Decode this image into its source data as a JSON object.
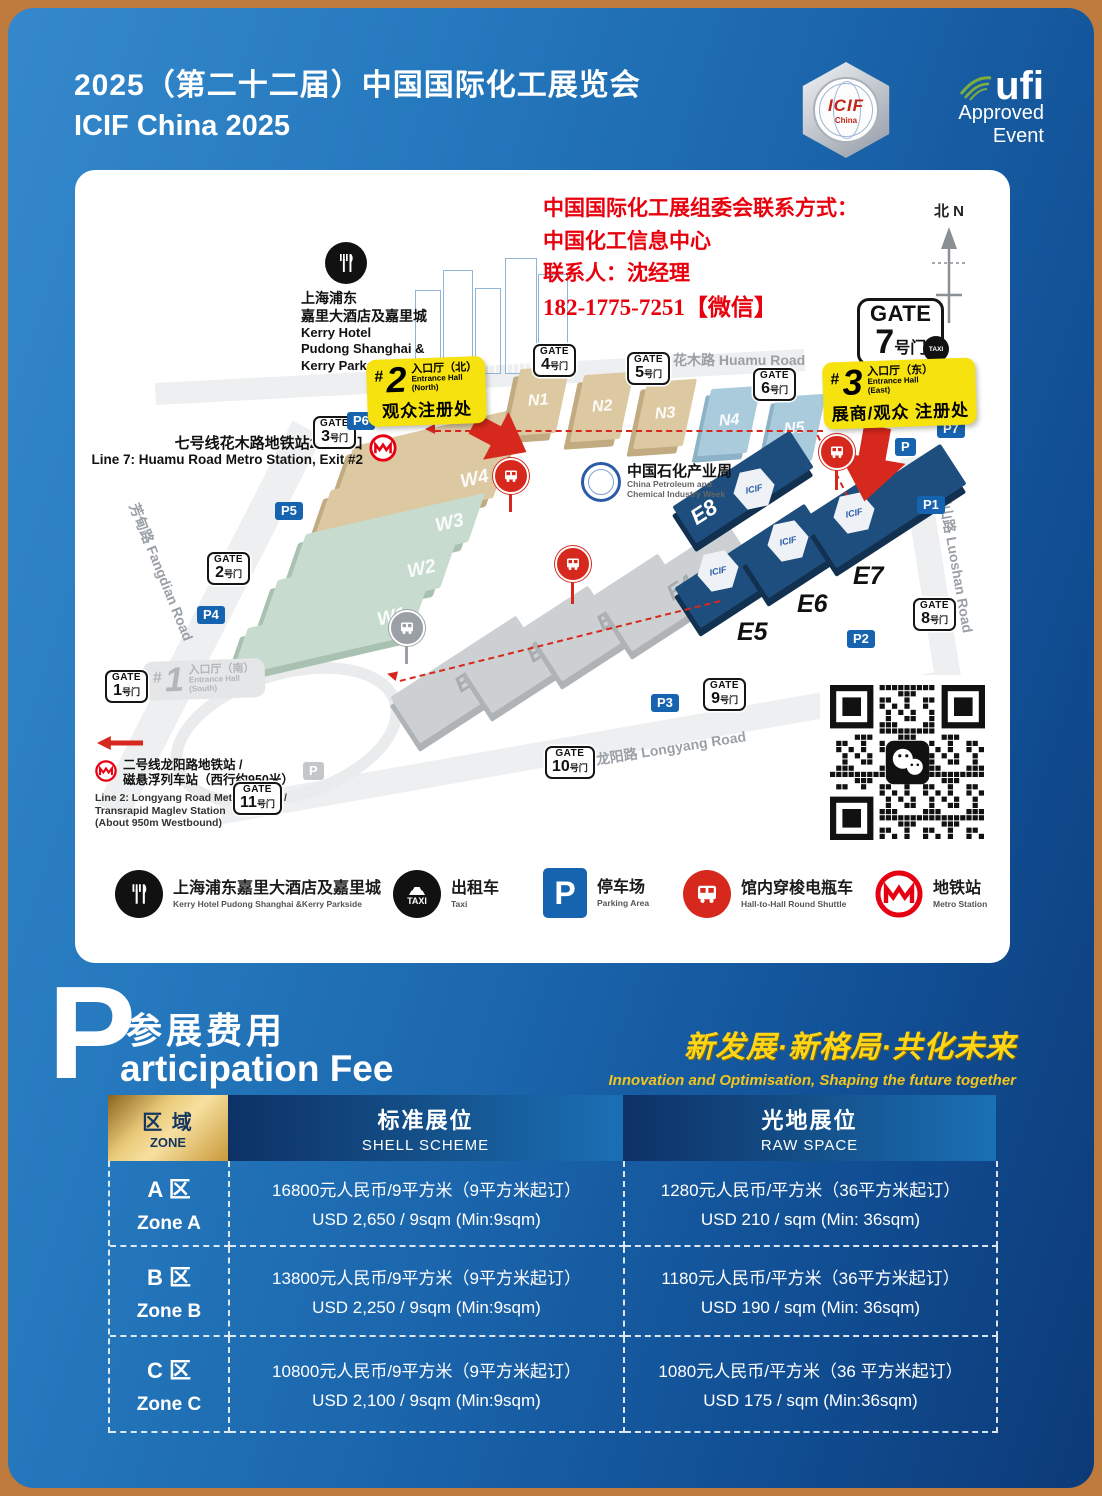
{
  "header": {
    "title_zh": "2025（第二十二届）中国国际化工展览会",
    "title_en": "ICIF China 2025",
    "icif_logo": {
      "text": "ICIF",
      "sub": "China"
    },
    "ufi": {
      "name": "ufi",
      "line1": "Approved",
      "line2": "Event"
    }
  },
  "map": {
    "contact": {
      "line1": "中国国际化工展组委会联系方式：",
      "line2": "中国化工信息中心",
      "line3": "联系人：沈经理",
      "line4": "182-1775-7251【微信】"
    },
    "compass": {
      "zh": "北",
      "en": "N"
    },
    "hash": "#",
    "gate_word": "GATE",
    "gate_suffix": "号门",
    "gates": {
      "g1": "1",
      "g2": "2",
      "g3": "3",
      "g4": "4",
      "g5": "5",
      "g6": "6",
      "g7": "7",
      "g8": "8",
      "g9": "9",
      "g10": "10",
      "g11": "11"
    },
    "parking": {
      "p1": "P1",
      "p2": "P2",
      "p3": "P3",
      "p4": "P4",
      "p5": "P5",
      "p6": "P6",
      "p7": "P7",
      "vip": "P",
      "gray": "P"
    },
    "halls": {
      "w1": "W1",
      "w2": "W2",
      "w3": "W3",
      "w4": "W4",
      "w5": "W5",
      "n1": "N1",
      "n2": "N2",
      "n3": "N3",
      "n4": "N4",
      "n5": "N5",
      "e1": "E1",
      "e2": "E2",
      "e3": "E3",
      "e4": "E4",
      "e5": "E5",
      "e6": "E6",
      "e7": "E7",
      "e8": "E8"
    },
    "icif_badge": "ICIF",
    "roads": {
      "huamu": "花木路  Huamu Road",
      "fangdian": "芳甸路  Fangdian Road",
      "luoshan": "罗山路  Luoshan Road",
      "longyang": "龙阳路  Longyang Road"
    },
    "kerry": {
      "zh1": "上海浦东",
      "zh2": "嘉里大酒店及嘉里城",
      "en1": "Kerry Hotel",
      "en2": "Pudong Shanghai &",
      "en3": "Kerry Parkside"
    },
    "line7": {
      "zh": "七号线花木路地铁站2号出口",
      "en": "Line 7: Huamu Road Metro Station, Exit #2"
    },
    "line2": {
      "zh1": "二号线龙阳路地铁站 /",
      "zh2": "磁悬浮列车站（西行约950米）",
      "en1": "Line 2: Longyang Road Metro Station /",
      "en2": "Transrapid Maglev Station",
      "en3": "(About 950m Westbound)"
    },
    "petro": {
      "zh": "中国石化产业周",
      "en1": "China Petroleum and",
      "en2": "Chemical Industry Week"
    },
    "entrance1": {
      "num": "1",
      "zh": "入口厅（南）",
      "en1": "Entrance Hall",
      "en2": "(South)"
    },
    "entrance2": {
      "num": "2",
      "zh": "入口厅（北）",
      "en1": "Entrance Hall",
      "en2": "(North)",
      "sub": "观众注册处"
    },
    "entrance3": {
      "num": "3",
      "zh": "入口厅（东）",
      "en1": "Entrance Hall",
      "en2": "(East)",
      "sub": "展商/观众 注册处"
    },
    "taxi": "TAXI"
  },
  "legend": {
    "taxi_text": "TAXI",
    "p_text": "P",
    "items": [
      {
        "zh": "上海浦东嘉里大酒店及嘉里城",
        "en": "Kerry Hotel Pudong Shanghai &Kerry Parkside"
      },
      {
        "zh": "出租车",
        "en": "Taxi"
      },
      {
        "zh": "停车场",
        "en": "Parking Area"
      },
      {
        "zh": "馆内穿梭电瓶车",
        "en": "Hall-to-Hall Round Shuttle"
      },
      {
        "zh": "地铁站",
        "en": "Metro Station"
      }
    ]
  },
  "fee": {
    "big_letter": "P",
    "title_zh": "参展费用",
    "title_en": "articipation Fee",
    "slogan_zh": "新发展·新格局·共化未来",
    "slogan_en": "Innovation and Optimisation, Shaping the future together",
    "table": {
      "zone_header": {
        "zh": "区 域",
        "en": "ZONE"
      },
      "shell_header": {
        "zh": "标准展位",
        "en": "SHELL SCHEME"
      },
      "raw_header": {
        "zh": "光地展位",
        "en": "RAW SPACE"
      },
      "rows": [
        {
          "zone_zh": "A 区",
          "zone_en": "Zone A",
          "shell_zh": "16800元人民币/9平方米（9平方米起订）",
          "shell_en": "USD  2,650 / 9sqm (Min:9sqm)",
          "raw_zh": "1280元人民币/平方米（36平方米起订）",
          "raw_en": "USD  210 / sqm (Min: 36sqm)"
        },
        {
          "zone_zh": "B 区",
          "zone_en": "Zone B",
          "shell_zh": "13800元人民币/9平方米（9平方米起订）",
          "shell_en": "USD  2,250 / 9sqm (Min:9sqm)",
          "raw_zh": "1180元人民币/平方米（36平方米起订）",
          "raw_en": "USD  190 / sqm (Min: 36sqm)"
        },
        {
          "zone_zh": "C 区",
          "zone_en": "Zone C",
          "shell_zh": "10800元人民币/9平方米（9平方米起订）",
          "shell_en": "USD  2,100 / 9sqm (Min:9sqm)",
          "raw_zh": "1080元人民币/平方米（36 平方米起订）",
          "raw_en": "USD  175 / sqm (Min:36sqm)"
        }
      ]
    }
  }
}
